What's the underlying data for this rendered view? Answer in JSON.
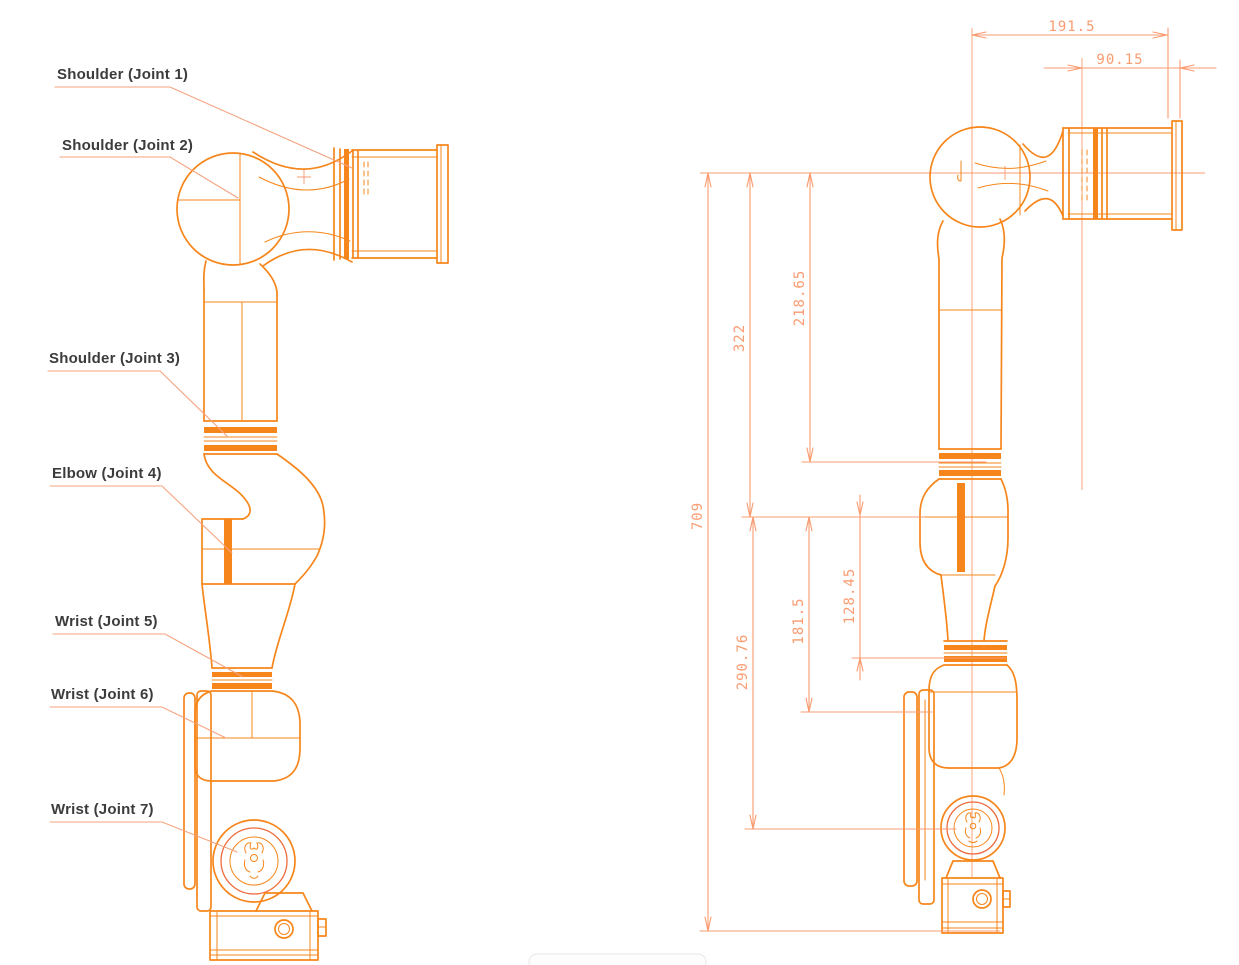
{
  "colors": {
    "outline_orange": "#F6861B",
    "accent_red_orange": "#EE6A3C",
    "dimension_salmon": "#FA9B70",
    "leader_salmon": "#F6A27E",
    "label_text": "#3C3C3C",
    "background": "#FFFFFF"
  },
  "left_view": {
    "joint_labels": [
      {
        "text": "Shoulder (Joint 1)"
      },
      {
        "text": "Shoulder (Joint 2)"
      },
      {
        "text": "Shoulder (Joint 3)"
      },
      {
        "text": "Elbow (Joint 4)"
      },
      {
        "text": "Wrist (Joint 5)"
      },
      {
        "text": "Wrist (Joint 6)"
      },
      {
        "text": "Wrist (Joint 7)"
      }
    ]
  },
  "right_view": {
    "dimensions": [
      {
        "orientation": "horizontal",
        "value": "191.5"
      },
      {
        "orientation": "horizontal",
        "value": "90.15"
      },
      {
        "orientation": "vertical",
        "value": "218.65"
      },
      {
        "orientation": "vertical",
        "value": "322"
      },
      {
        "orientation": "vertical",
        "value": "709"
      },
      {
        "orientation": "vertical",
        "value": "128.45"
      },
      {
        "orientation": "vertical",
        "value": "181.5"
      },
      {
        "orientation": "vertical",
        "value": "290.76"
      }
    ]
  }
}
